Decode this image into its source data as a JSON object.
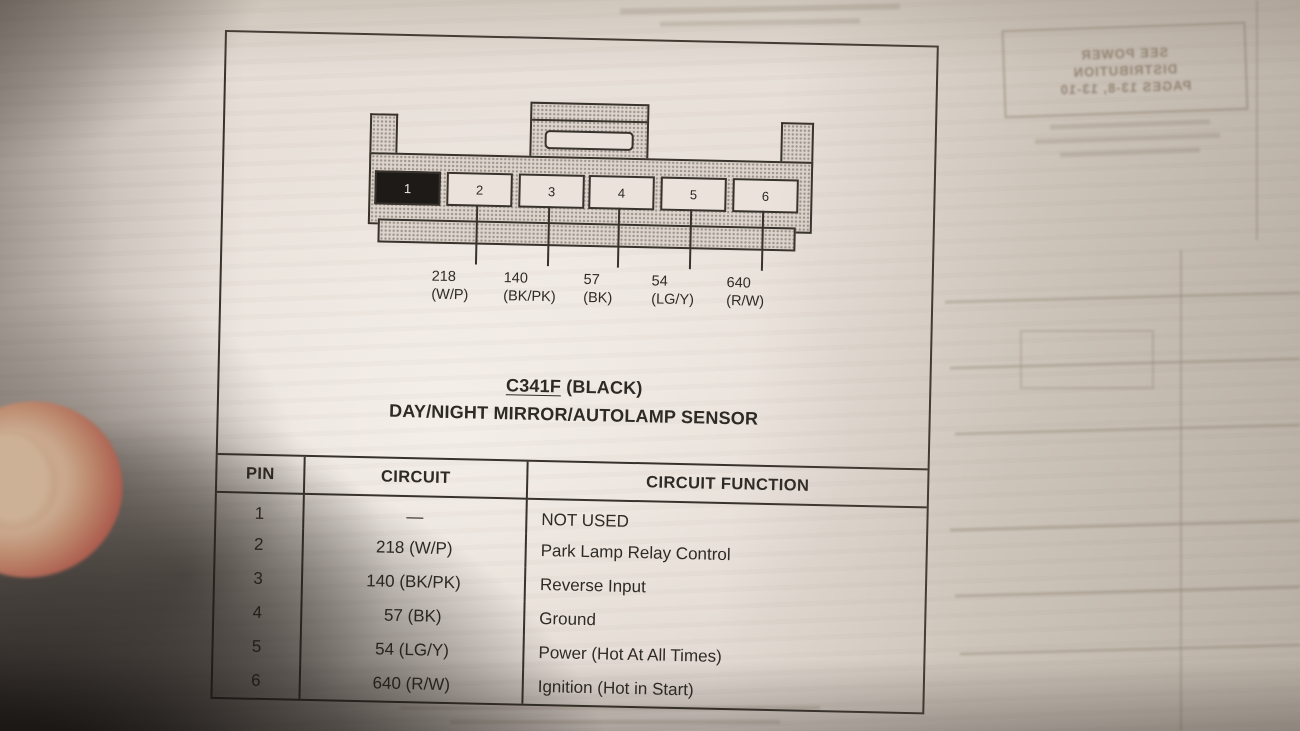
{
  "figure": {
    "connector": {
      "pins": [
        {
          "number": "1",
          "filled": true
        },
        {
          "number": "2",
          "filled": false
        },
        {
          "number": "3",
          "filled": false
        },
        {
          "number": "4",
          "filled": false
        },
        {
          "number": "5",
          "filled": false
        },
        {
          "number": "6",
          "filled": false
        }
      ],
      "callouts": [
        {
          "circuit": "218",
          "code": "(W/P)"
        },
        {
          "circuit": "140",
          "code": "(BK/PK)"
        },
        {
          "circuit": "57",
          "code": "(BK)"
        },
        {
          "circuit": "54",
          "code": "(LG/Y)"
        },
        {
          "circuit": "640",
          "code": "(R/W)"
        }
      ]
    },
    "title": {
      "connector_id": "C341F",
      "color_note": " (BLACK)",
      "device_name": "DAY/NIGHT MIRROR/AUTOLAMP SENSOR"
    },
    "table": {
      "headers": {
        "pin": "PIN",
        "circuit": "CIRCUIT",
        "function": "CIRCUIT FUNCTION"
      },
      "rows": [
        {
          "pin": "1",
          "circuit": "—",
          "function": "NOT USED"
        },
        {
          "pin": "2",
          "circuit": "218 (W/P)",
          "function": "Park Lamp Relay Control"
        },
        {
          "pin": "3",
          "circuit": "140 (BK/PK)",
          "function": "Reverse Input"
        },
        {
          "pin": "4",
          "circuit": "57 (BK)",
          "function": "Ground"
        },
        {
          "pin": "5",
          "circuit": "54 (LG/Y)",
          "function": "Power (Hot At All Times)"
        },
        {
          "pin": "6",
          "circuit": "640 (R/W)",
          "function": "Ignition (Hot in Start)"
        }
      ]
    }
  },
  "ghost_bleedthrough": {
    "note_lines": [
      "SEE POWER",
      "DISTRIBUTION",
      "PAGES 13-8, 13-10"
    ]
  },
  "colors": {
    "paper_light": "#e9e1da",
    "paper_tan": "#c9c0b3",
    "ink": "#38322c",
    "pin1_fill": "#1d1a17",
    "shadow": "#261f1b",
    "finger_skin": "#ad5f50",
    "fingernail": "#cdb196"
  }
}
